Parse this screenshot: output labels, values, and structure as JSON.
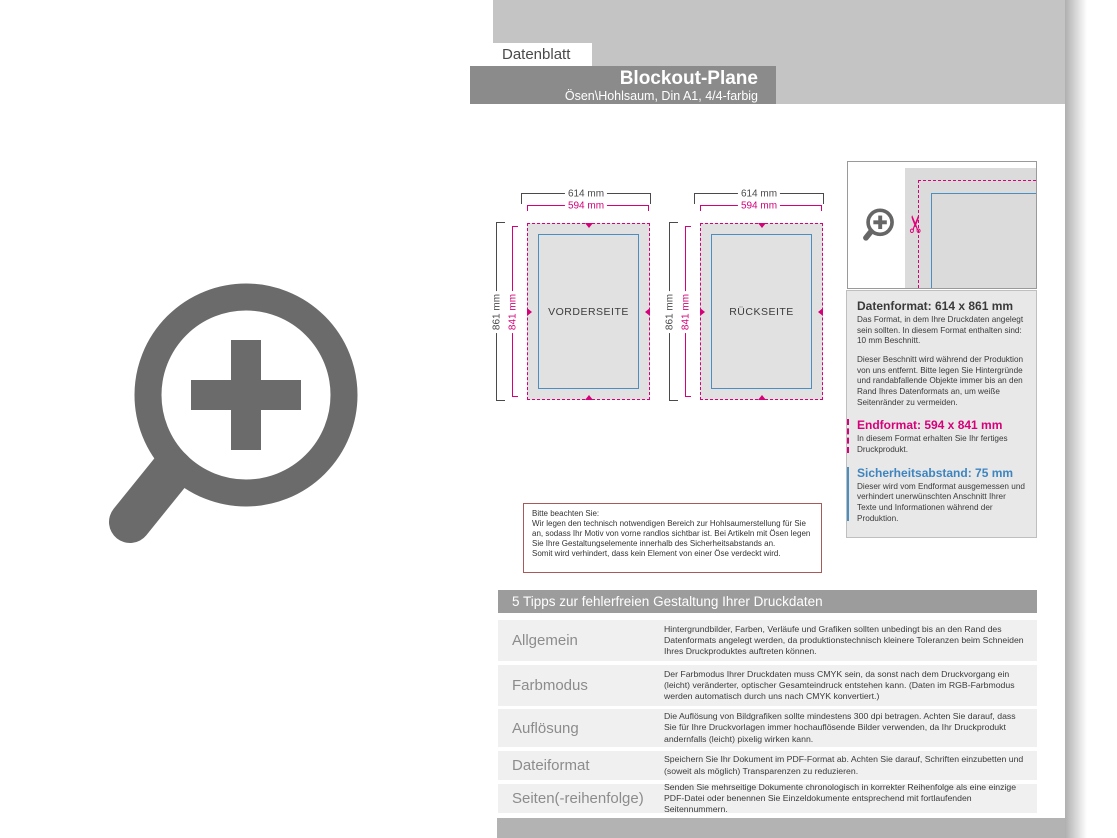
{
  "header": {
    "tab": "Datenblatt",
    "title": "Blockout-Plane",
    "subtitle": "Ösen\\Hohlsaum, Din A1, 4/4-farbig"
  },
  "diagrams": [
    {
      "name": "VORDERSEITE",
      "outer_width": "614 mm",
      "end_width": "594 mm",
      "outer_height": "861 mm",
      "end_height": "841 mm"
    },
    {
      "name": "RÜCKSEITE",
      "outer_width": "614 mm",
      "end_width": "594 mm",
      "outer_height": "861 mm",
      "end_height": "841 mm"
    }
  ],
  "info_panel": {
    "datenformat": {
      "heading": "Datenformat: 614 x 861 mm",
      "body1": "Das Format, in dem Ihre Druckdaten angelegt sein sollten. In diesem Format enthalten sind: 10 mm Beschnitt.",
      "body2": "Dieser Beschnitt wird während der Produktion von uns entfernt. Bitte legen Sie Hintergründe und randabfallende Objekte immer bis an den Rand Ihres Datenformats an, um weiße Seitenränder zu vermeiden."
    },
    "endformat": {
      "heading": "Endformat: 594 x 841 mm",
      "body": "In diesem Format erhalten Sie Ihr fertiges Druckprodukt."
    },
    "sicherheitsabstand": {
      "heading": "Sicherheitsabstand: 75 mm",
      "body": "Dieser wird vom Endformat ausgemessen und verhindert unerwünschten Anschnitt Ihrer Texte und Informationen während der Produktion."
    }
  },
  "note_box": {
    "title": "Bitte beachten Sie:",
    "body1": "Wir legen den technisch notwendigen Bereich zur Hohlsaumerstellung für Sie an, sodass Ihr Motiv von vorne randlos sichtbar ist. Bei Artikeln mit Ösen legen Sie Ihre Gestaltungselemente innerhalb des Sicherheitsabstands an.",
    "body2": "Somit wird verhindert, dass kein Element von einer Öse verdeckt wird."
  },
  "tips": {
    "header": "5 Tipps zur fehlerfreien Gestaltung Ihrer Druckdaten",
    "rows": [
      {
        "label": "Allgemein",
        "text": "Hintergrundbilder, Farben, Verläufe und Grafiken sollten unbedingt bis an den Rand des Datenformats angelegt werden, da produktionstechnisch kleinere Toleranzen beim Schneiden Ihres Druckproduktes auftreten können."
      },
      {
        "label": "Farbmodus",
        "text": "Der Farbmodus Ihrer Druckdaten muss CMYK sein, da sonst nach dem Druckvorgang ein (leicht) veränderter, optischer Gesamteindruck entstehen kann. (Daten im RGB-Farbmodus werden automatisch durch uns nach CMYK konvertiert.)"
      },
      {
        "label": "Auflösung",
        "text": "Die Auflösung von Bildgrafiken sollte mindestens 300 dpi betragen. Achten Sie darauf, dass Sie für Ihre Druckvorlagen immer hochauflösende Bilder verwenden, da Ihr Druckprodukt andernfalls (leicht) pixelig wirken kann."
      },
      {
        "label": "Dateiformat",
        "text": "Speichern Sie Ihr Dokument im PDF-Format ab. Achten Sie darauf, Schriften einzubetten und (soweit als möglich) Transparenzen zu reduzieren."
      },
      {
        "label": "Seiten(-reihenfolge)",
        "text": "Senden Sie mehrseitige Dokumente chronologisch in korrekter Reihenfolge als eine einzige PDF-Datei oder benennen Sie Einzeldokumente entsprechend mit fortlaufenden Seitennummern."
      }
    ]
  },
  "icons": {
    "scissors_glyph": "✂"
  },
  "colors": {
    "magenta": "#d6007a",
    "blue": "#4a8fc0",
    "note_border": "#a85a5a",
    "bar_dark": "#8b8b8b",
    "band_light": "#c5c4c4"
  }
}
